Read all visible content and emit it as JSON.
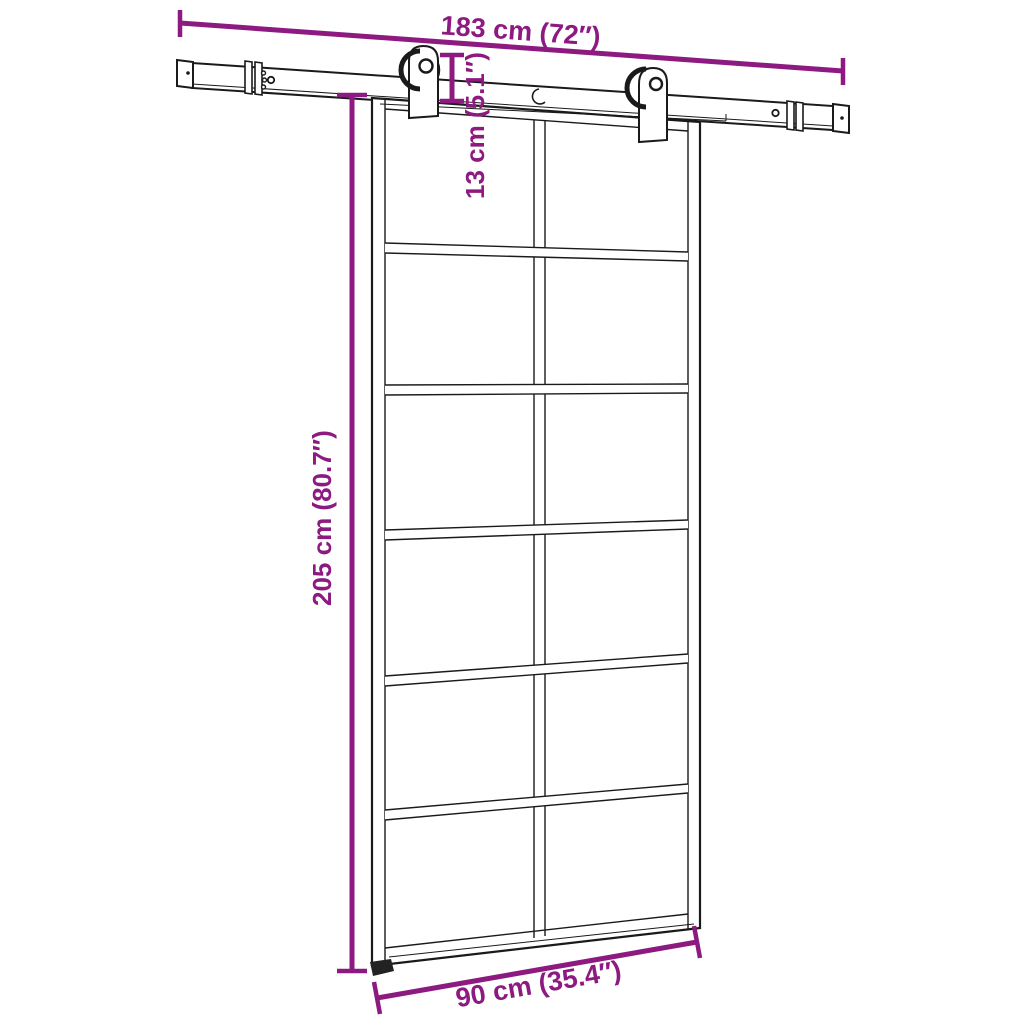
{
  "colors": {
    "background": "#ffffff",
    "drawing_line": "#1a1a1a",
    "dimension": "#8D1A80"
  },
  "dimensions": {
    "track_length": "183 cm (72″)",
    "drop_height": "13 cm (5.1″)",
    "door_height": "205 cm (80.7″)",
    "door_width": "90 cm (35.4″)"
  },
  "door": {
    "grid_columns": 2,
    "grid_rows": 6,
    "pane_count": 12,
    "hardware": "sliding-barn-door-track-with-two-rollers"
  }
}
